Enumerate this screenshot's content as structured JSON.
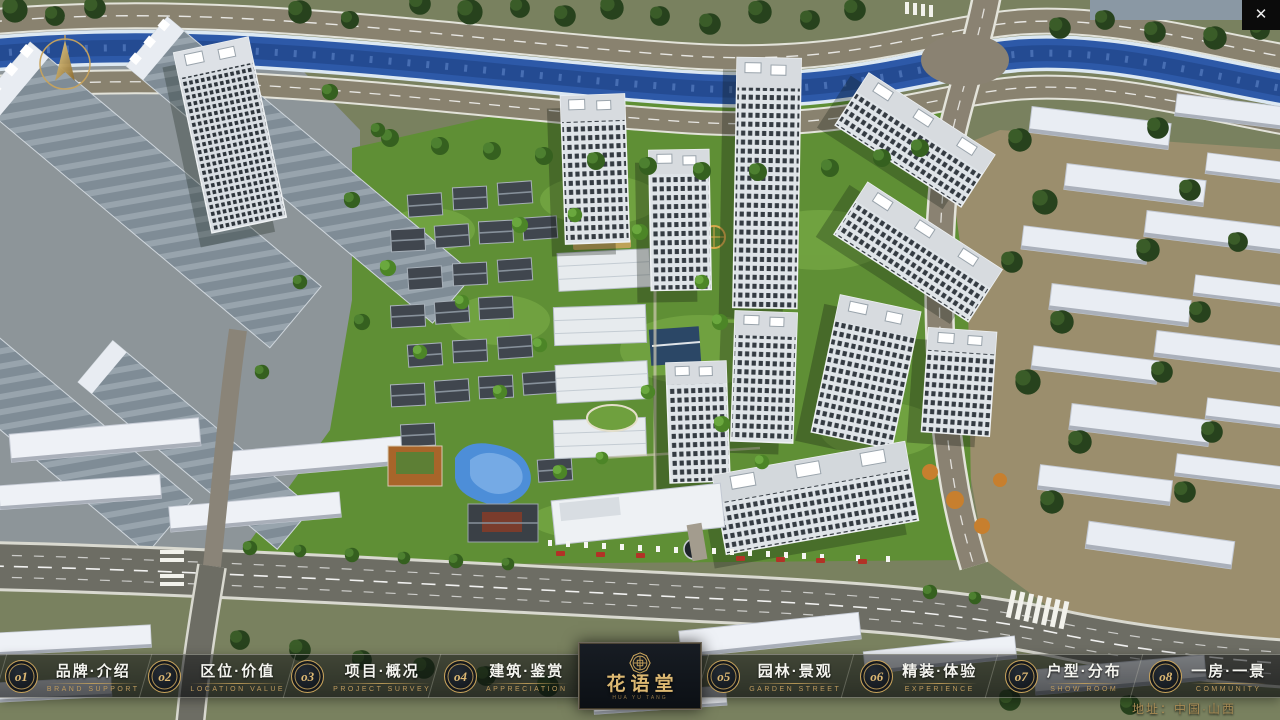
{
  "window": {
    "close_icon": "✕"
  },
  "nav": {
    "items": [
      {
        "num": "o1",
        "title": "品牌·介绍",
        "subtitle": "BRAND SUPPORT"
      },
      {
        "num": "o2",
        "title": "区位·价值",
        "subtitle": "LOCATION VALUE"
      },
      {
        "num": "o3",
        "title": "项目·概况",
        "subtitle": "PROJECT SURVEY"
      },
      {
        "num": "o4",
        "title": "建筑·鉴赏",
        "subtitle": "APPRECIATION"
      },
      {
        "num": "o5",
        "title": "园林·景观",
        "subtitle": "GARDEN STREET"
      },
      {
        "num": "o6",
        "title": "精装·体验",
        "subtitle": "EXPERIENCE"
      },
      {
        "num": "o7",
        "title": "户型·分布",
        "subtitle": "SHOW ROOM"
      },
      {
        "num": "o8",
        "title": "一房·一景",
        "subtitle": "COMMUNITY"
      }
    ]
  },
  "logo": {
    "title": "花语堂",
    "subtitle": "HUA YU TANG"
  },
  "footer": {
    "address": "地址：中国·山西"
  },
  "scene": {
    "palette": {
      "river": "#2d59a8",
      "lawn": "#5f8f35",
      "road": "#6d6d64",
      "tree_dark": "#27421d",
      "tree_light": "#6aa83e",
      "building_white": "#e9edf3",
      "gold_accent": "#c9a45c"
    }
  }
}
